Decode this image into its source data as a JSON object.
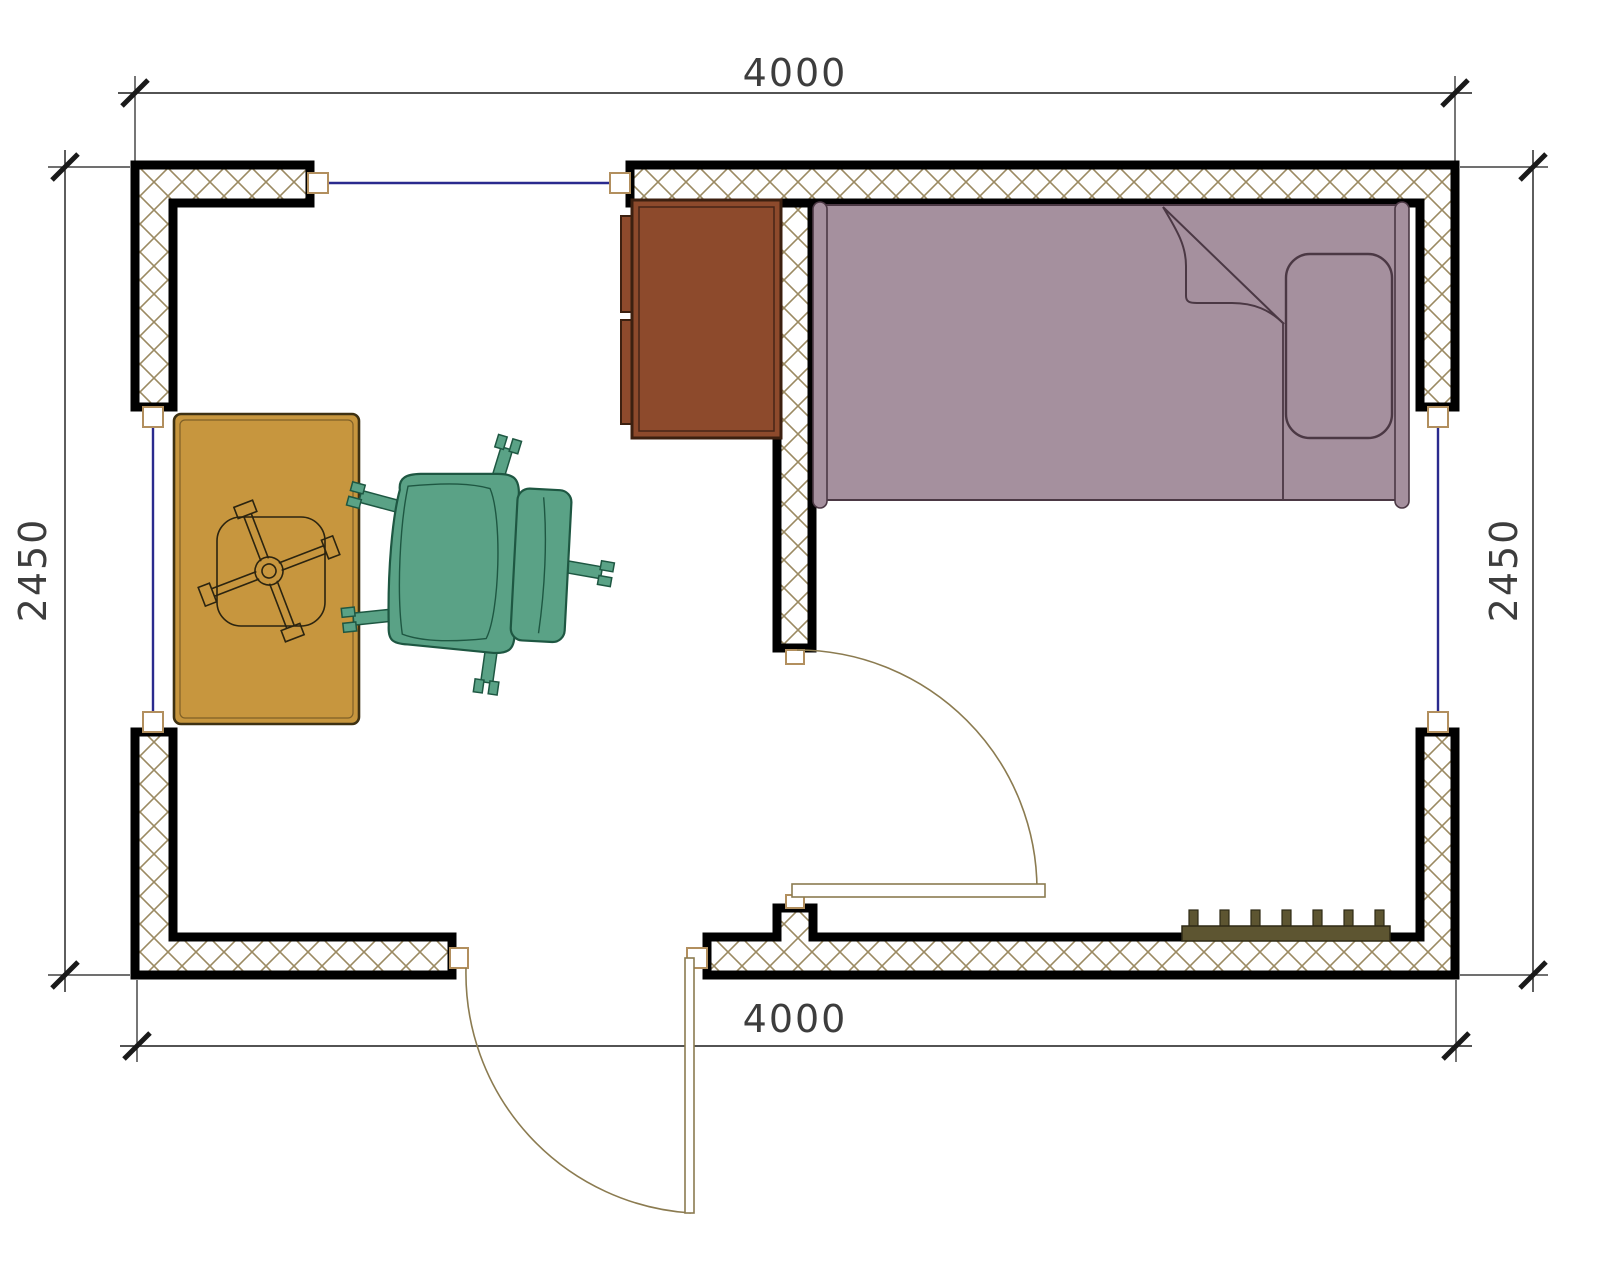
{
  "drawing": {
    "type": "floor plan",
    "dimensions": {
      "top": "4000",
      "bottom": "4000",
      "left": "2450",
      "right": "2450"
    },
    "objects": [
      "single-bed",
      "pillow",
      "blanket-fold",
      "desk",
      "table-with-x-base",
      "office-swivel-chair",
      "radiator",
      "exterior-door",
      "interior-door",
      "window-top",
      "window-left",
      "window-right"
    ],
    "colors": {
      "background": "#ffffff",
      "wall_outline": "#000000",
      "wall_hatch": "#9b8a62",
      "window_frame": "#b28f5e",
      "window_glass": "#2a2a8e",
      "door_swing": "#8b7b50",
      "dim_line": "#1a1a1a",
      "dim_text": "#3d3d3d",
      "desk_fill": "#8d4a2c",
      "desk_outline": "#3c2010",
      "bed_fill": "#a5909e",
      "bed_outline": "#4b3844",
      "table_fill": "#c7963e",
      "table_outline": "#3e3112",
      "chair_fill": "#5aa286",
      "chair_outline": "#1e5742",
      "radiator_fill": "#5d5531",
      "radiator_outline": "#2e2a15"
    }
  }
}
